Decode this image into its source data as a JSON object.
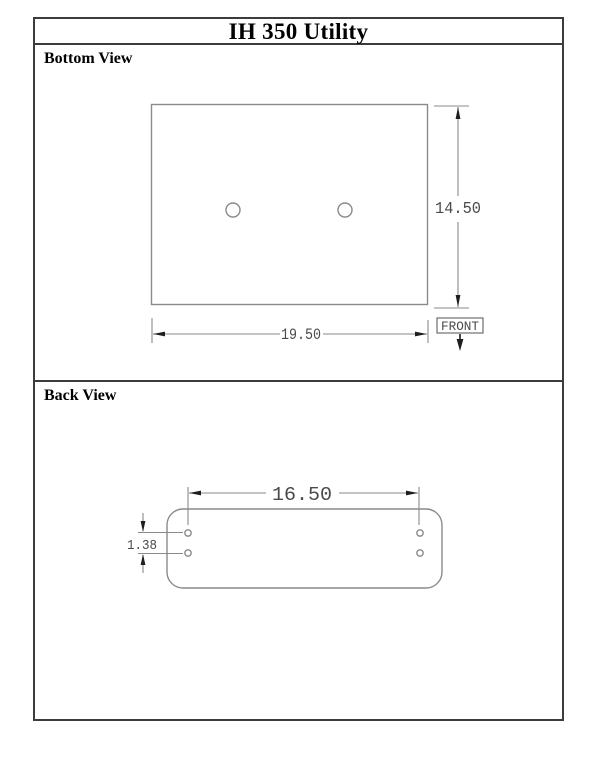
{
  "title": "IH 350 Utility",
  "colors": {
    "frame": "#3c3c3c",
    "drawing_line": "#8a8a8a",
    "dimension_text": "#4a4a4a",
    "arrow": "#1e1e1e",
    "background": "#ffffff"
  },
  "sections": {
    "bottom_view": {
      "label": "Bottom View",
      "dimensions": {
        "width": "19.50",
        "height": "14.50"
      },
      "front_label": "FRONT",
      "hole_count": 2
    },
    "back_view": {
      "label": "Back View",
      "dimensions": {
        "width": "16.50",
        "hole_row_spacing": "1.38"
      },
      "hole_count": 4
    }
  }
}
